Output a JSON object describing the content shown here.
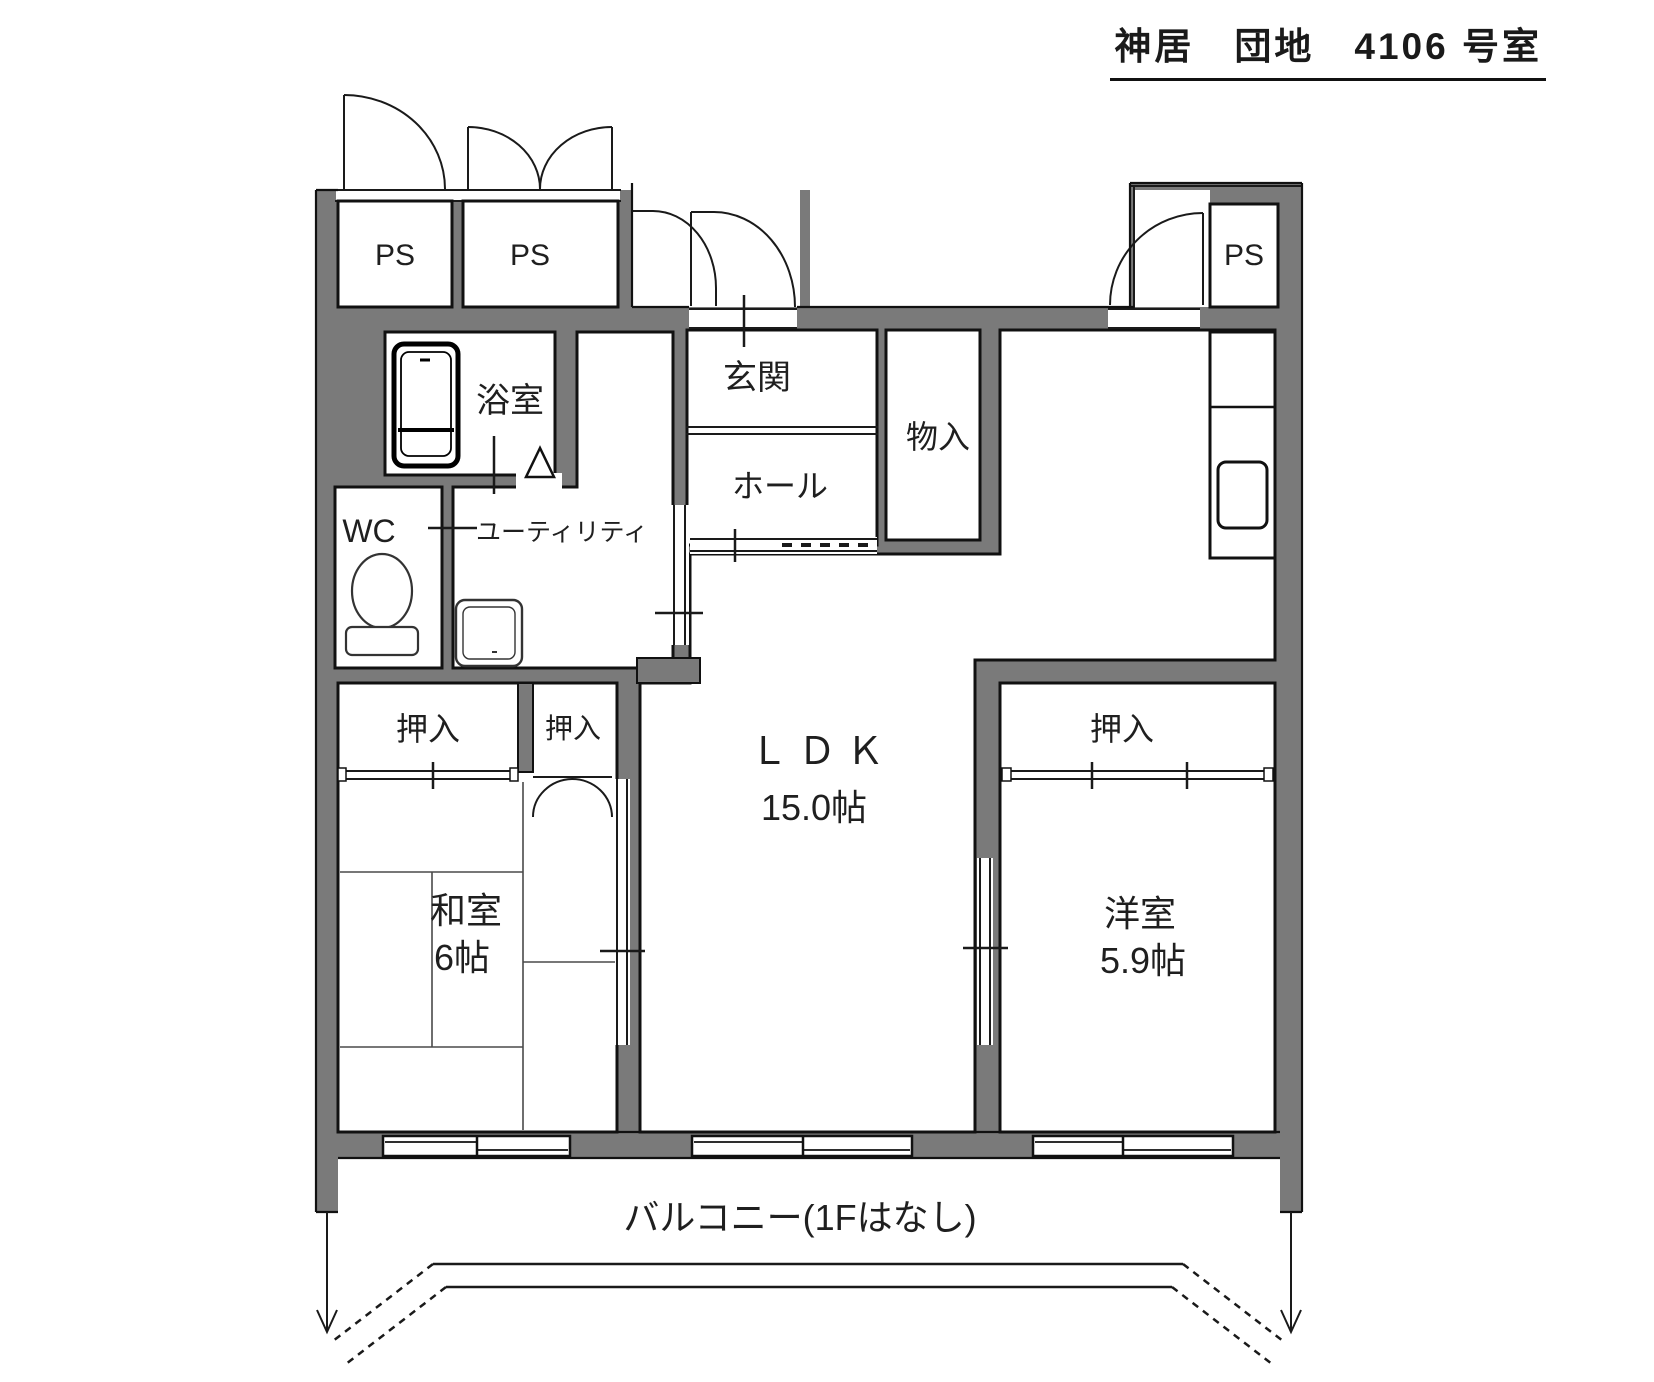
{
  "title": "神居　団地　4106 号室",
  "colors": {
    "wall": "#7a7a7a",
    "line": "#1a1a1a",
    "background": "#ffffff"
  },
  "labels": {
    "ps_left": "PS",
    "ps_mid": "PS",
    "ps_right": "PS",
    "bathroom": "浴室",
    "wc": "WC",
    "utility": "ユーティリティ",
    "entrance": "玄関",
    "hall": "ホール",
    "storage": "物入",
    "closet_left": "押入",
    "closet_small": "押入",
    "closet_right": "押入",
    "ldk_name": "ＬＤＫ",
    "ldk_size": "15.0帖",
    "japanese_room_name": "和室",
    "japanese_room_size": "6帖",
    "western_room_name": "洋室",
    "western_room_size": "5.9帖",
    "balcony": "バルコニー(1Fはなし)"
  }
}
